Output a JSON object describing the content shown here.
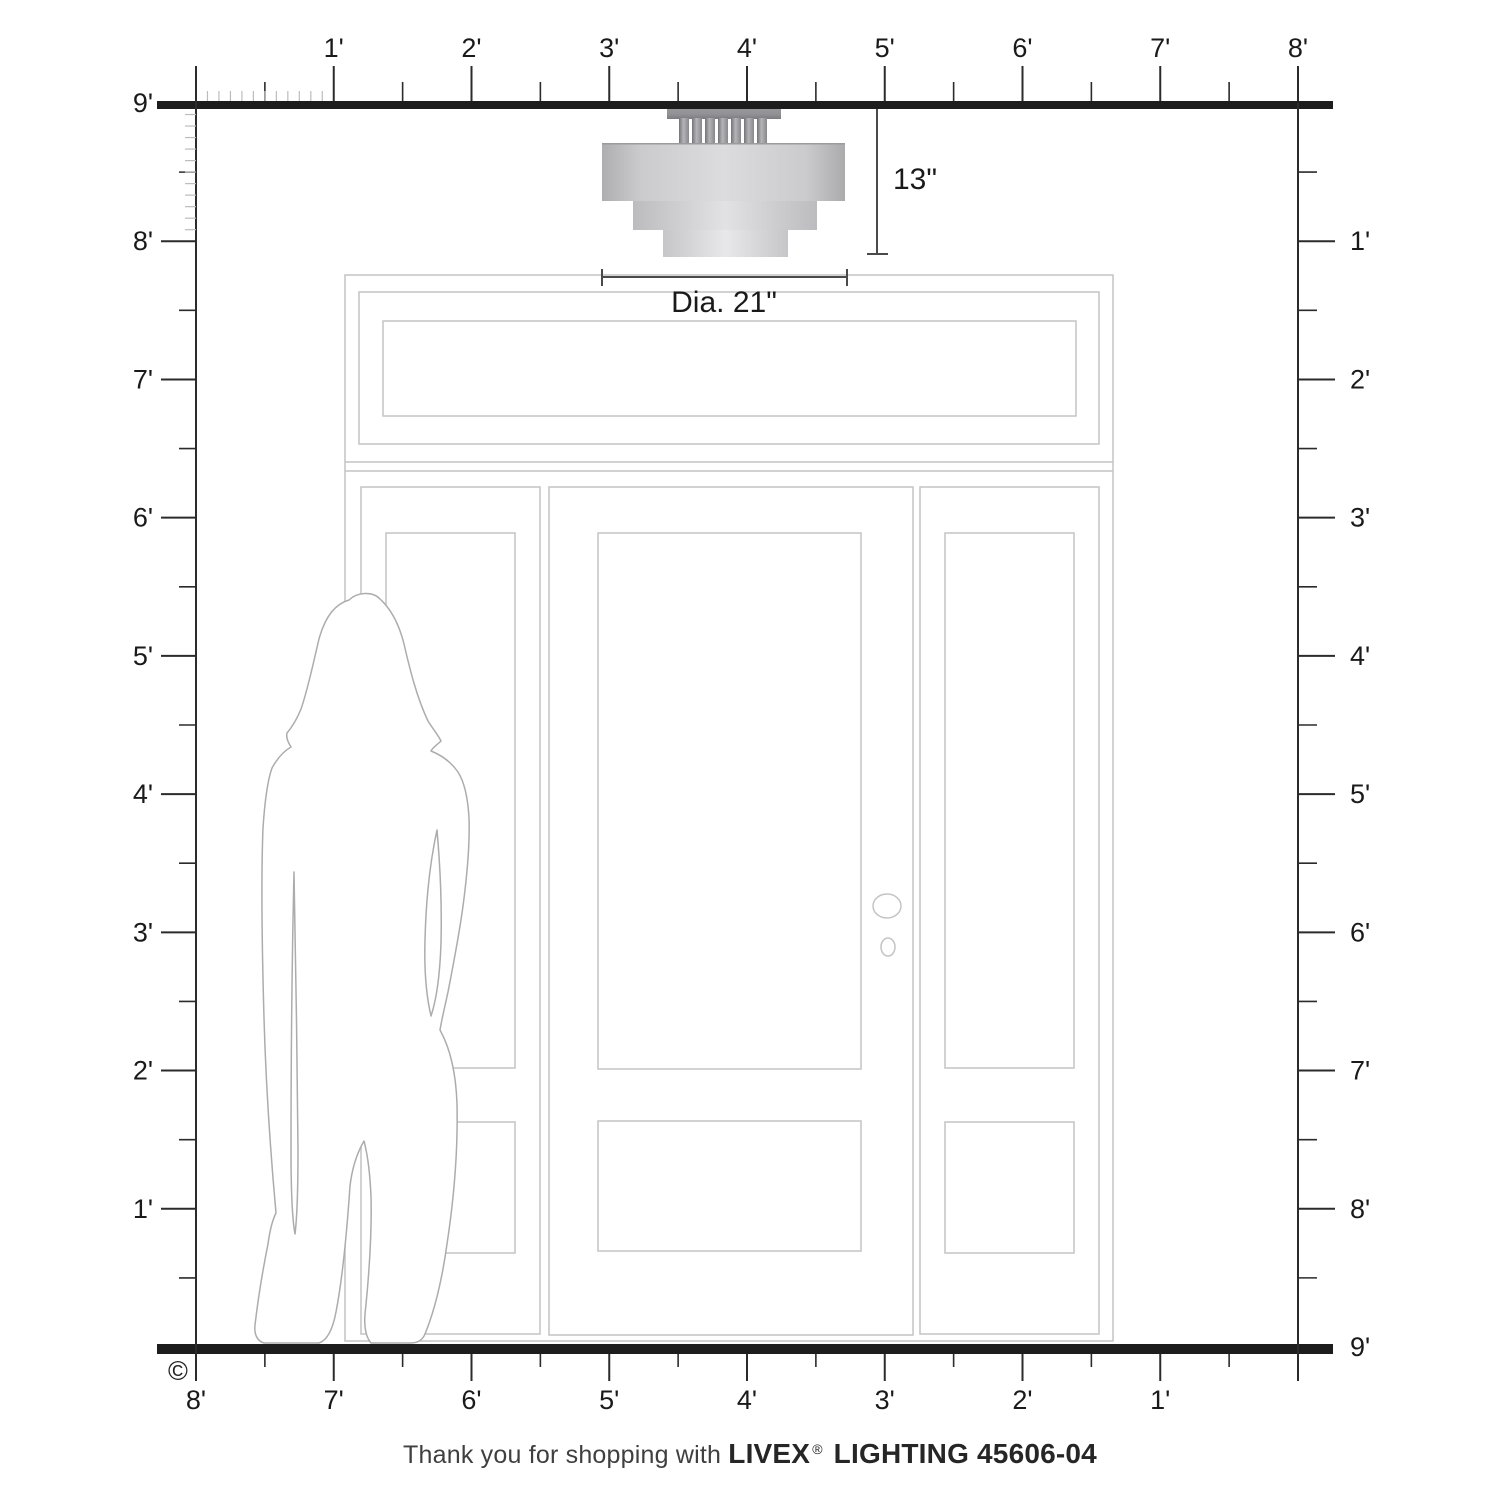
{
  "title": "Livex Lighting fixture scale diagram",
  "dimensions": {
    "height_label": "13\"",
    "diameter_label": "Dia. 21\""
  },
  "rulers": {
    "top_labels": [
      "1'",
      "2'",
      "3'",
      "4'",
      "5'",
      "6'",
      "7'",
      "8'"
    ],
    "left_labels": [
      "9'",
      "8'",
      "7'",
      "6'",
      "5'",
      "4'",
      "3'",
      "2'",
      "1'"
    ],
    "right_labels": [
      "1'",
      "2'",
      "3'",
      "4'",
      "5'",
      "6'",
      "7'",
      "8'",
      "9'"
    ],
    "bottom_labels": [
      "8'",
      "7'",
      "6'",
      "5'",
      "4'",
      "3'",
      "2'",
      "1'"
    ]
  },
  "copyright_symbol": "©",
  "caption": {
    "prefix": "Thank you for shopping with ",
    "brand": "LIVEX",
    "registered": "®",
    "suffix": " LIGHTING 45606-04"
  },
  "colors": {
    "ruler_bar": "#1d1d1d",
    "tick_major": "#2b2b2b",
    "tick_minor": "#bcbcbc",
    "label_text": "#1a1a1a",
    "dimension_line": "#4a4a4a",
    "door_line": "#c4c4c4",
    "figure_line": "#acacac",
    "caption_text": "#3f3f3f",
    "shade_center": "#dcdcde",
    "shade_edge": "#aeaeb1",
    "canopy_gray": "#95959a"
  }
}
